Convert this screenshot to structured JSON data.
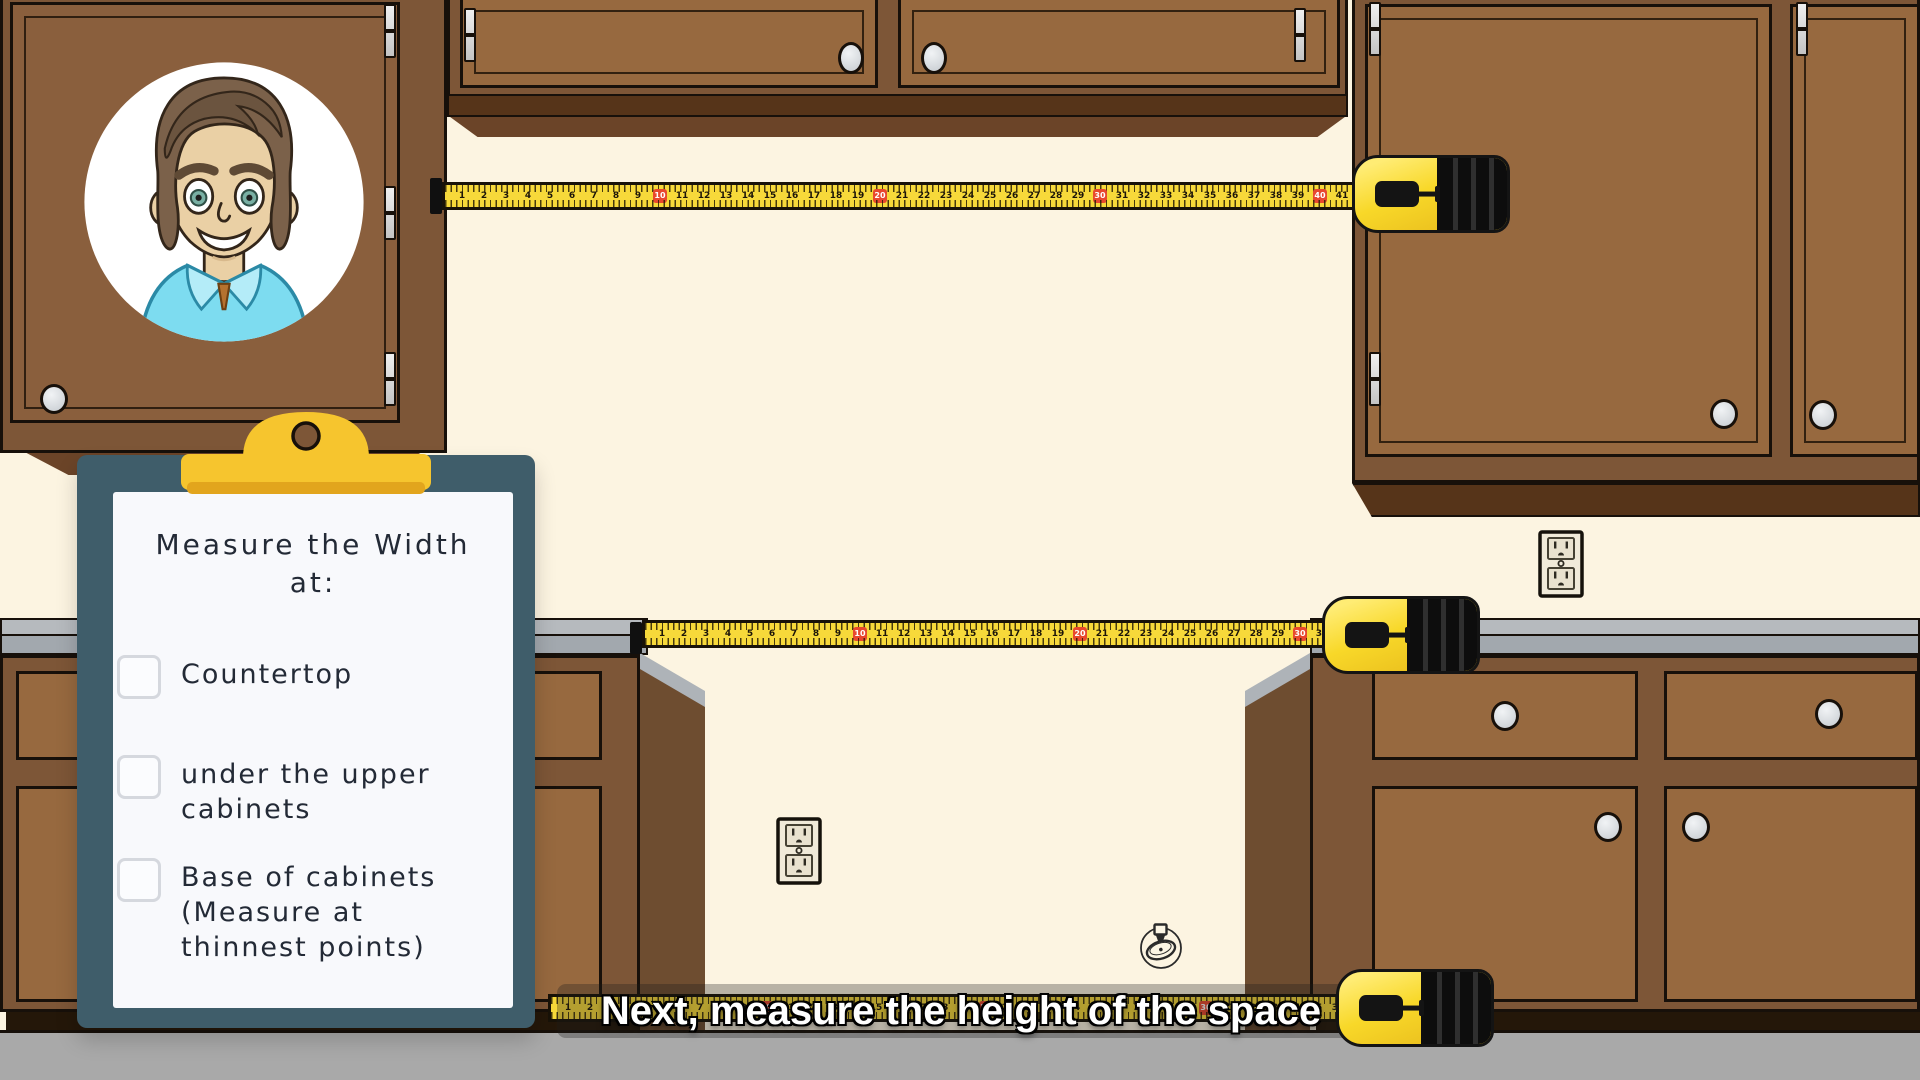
{
  "clipboard": {
    "title": "Measure the Width",
    "subtitle": "at:",
    "items": [
      {
        "label": "Countertop",
        "checked": false
      },
      {
        "label": "under the upper cabinets",
        "checked": false
      },
      {
        "label": "Base of cabinets (Measure at thinnest points)",
        "checked": false
      }
    ]
  },
  "caption": {
    "text": "Next, measure the height of the space"
  },
  "tapes": [
    {
      "name": "under-upper-cabinets-tape",
      "first": 1,
      "last": 41,
      "unit_px": 22,
      "red_every": 10
    },
    {
      "name": "countertop-tape",
      "first": 1,
      "last": 31,
      "unit_px": 22,
      "red_every": 10
    },
    {
      "name": "floor-tape",
      "first": 1,
      "last": 36,
      "unit_px": 22,
      "red_every": 10
    }
  ],
  "colors": {
    "wall": "#fcf4e1",
    "floor": "#a9a9a9",
    "cabinet_frame": "#7d5637",
    "cabinet_door": "#97693f",
    "cabinet_door_dark": "#8a5f3d",
    "under_cabinet_board": "#563419",
    "molding": "#6b4428",
    "cabinet_side": "#6e4d30",
    "outline": "#17100a",
    "counter_top": "#b6babe",
    "counter_front": "#a2a8ae",
    "counter_cap": "#aeb3b8",
    "tape_yellow": "#f7d93a",
    "tape_case_yellow": "#f8d829",
    "tape_marker_red": "#e8482e",
    "clipboard_board": "#3f5d6a",
    "clipboard_clip": "#f6c52e",
    "paper": "#f8f9fc",
    "knob": "#dfe3e6",
    "caption_text": "#ffffff"
  }
}
